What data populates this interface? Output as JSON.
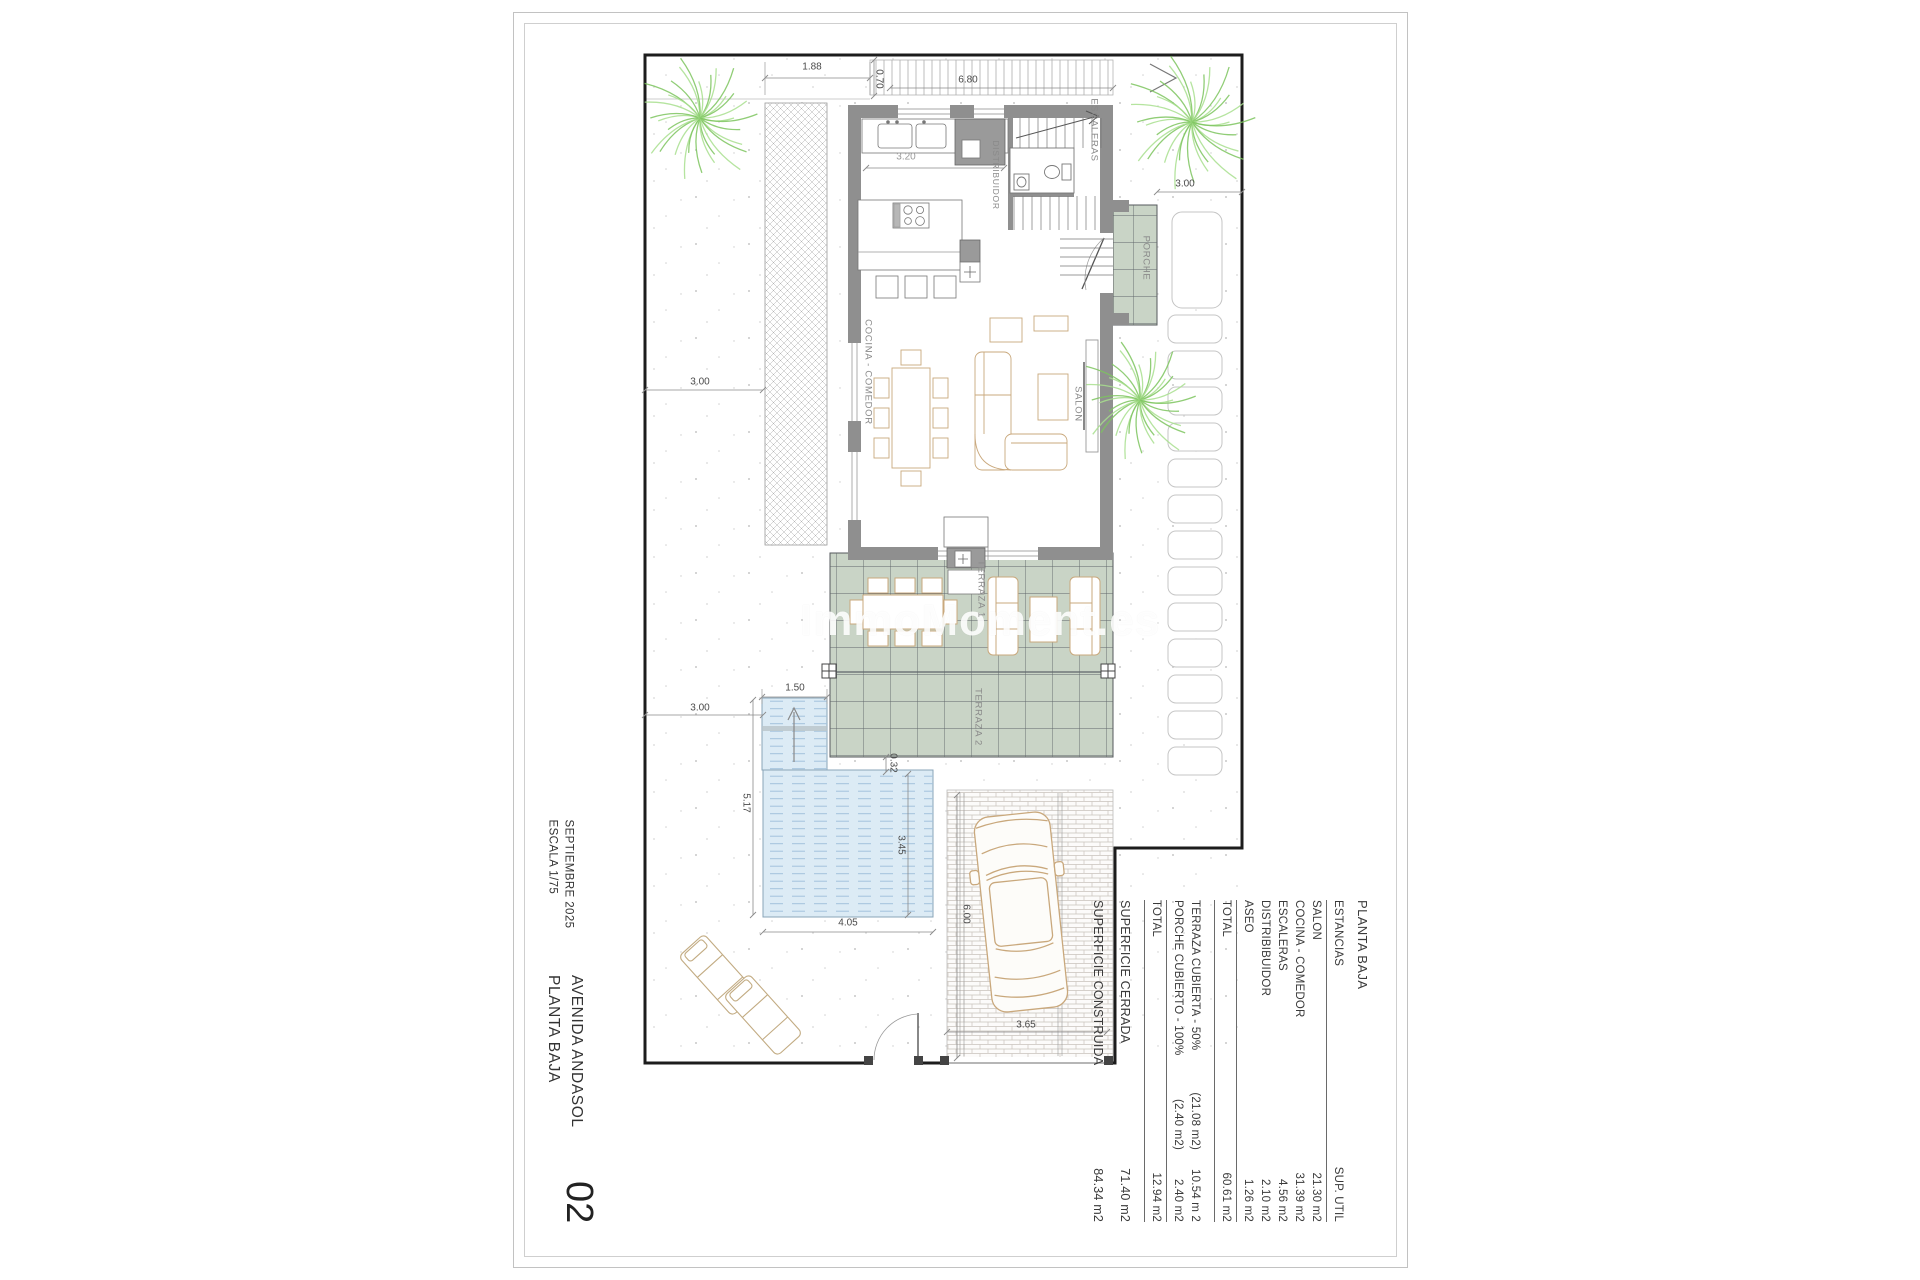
{
  "page": {
    "sheet_number": "02",
    "date": "SEPTIEMBRE 2025",
    "scale": "ESCALA 1/75",
    "project": "AVENIDA ANDASOL",
    "plan_title": "PLANTA BAJA",
    "watermark": "ImmoMoment.es"
  },
  "plan_labels": {
    "kitchen_dining": "COCINA - COMEDOR",
    "living_room": "SALON",
    "hallway": "DISTRIBUIDOR",
    "stairs": "ESCALERAS",
    "porch": "PORCHE",
    "terrace_1": "TERRAZA 1",
    "terrace_2": "TERRAZA 2"
  },
  "dimensions": {
    "top_left_width": "1.88",
    "top_depth": "0.70",
    "top_width": "6.80",
    "kitchen_width": "3.20",
    "porch_side": "3.00",
    "garden_upper": "3.00",
    "garden_lower": "3.00",
    "pool_steps_width": "1.50",
    "pool_length": "5.17",
    "pool_offset": "0.32",
    "pool_width": "3.45",
    "pool_bottom_width": "4.05",
    "drive_length": "6.00",
    "drive_width": "3.65"
  },
  "area_table": {
    "title": "PLANTA BAJA",
    "columns": {
      "room": "ESTANCIAS",
      "area": "SUP. UTIL"
    },
    "rows": [
      {
        "name": "SALON",
        "area": "21.30 m2"
      },
      {
        "name": "COCINA - COMEDOR",
        "area": "31.39 m2"
      },
      {
        "name": "ESCALERAS",
        "area": "4.56 m2"
      },
      {
        "name": "DISTRIBIBUIDOR",
        "area": "2.10 m2"
      },
      {
        "name": "ASEO",
        "area": "1.26 m2"
      }
    ],
    "total_label": "TOTAL",
    "total_area": "60.61 m2",
    "outdoor_rows": [
      {
        "name": "TERRAZA CUBIERTA - 50%",
        "gross": "(21.08 m2)",
        "area": "10.54 m 2"
      },
      {
        "name": "PORCHE CUBIERTO - 100%",
        "gross": "(2.40 m2)",
        "area": "2.40 m2"
      }
    ],
    "outdoor_total_label": "TOTAL",
    "outdoor_total_area": "12.94 m2",
    "closed_label": "SUPERFICIE CERRADA",
    "closed_area": "71.40 m2",
    "built_label": "SUPERFICIE CONSTRUIDA",
    "built_area": "84.34 m2"
  },
  "colors": {
    "terrace_green": "#c9d4c6",
    "pool_blue": "#dcebf5",
    "wall_gray": "#8f8f8f",
    "palm_green": "#8cc96b",
    "furniture_tan": "#c9a87c",
    "boundary_black": "#1c1c1c"
  }
}
